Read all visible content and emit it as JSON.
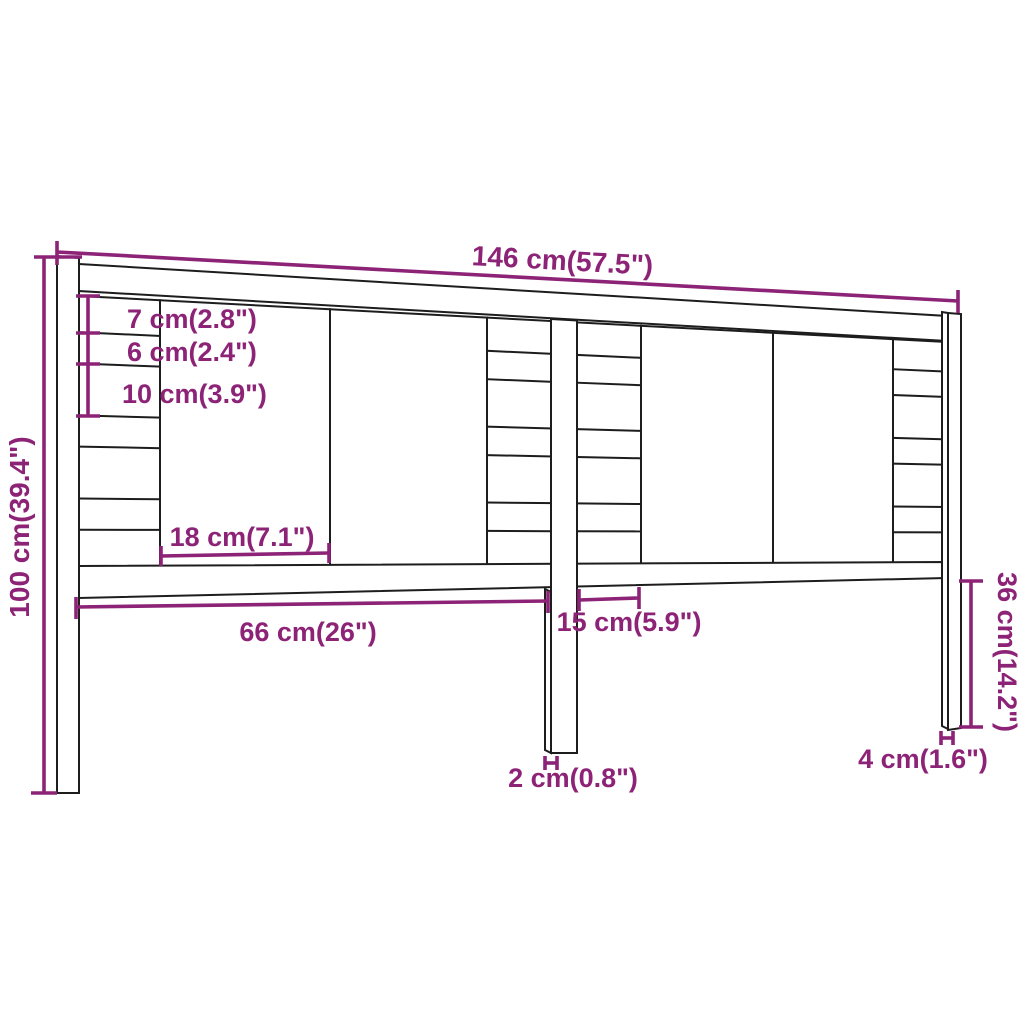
{
  "diagram": {
    "type": "furniture-dimension-drawing",
    "subject": "headboard line drawing with dimension callouts",
    "colors": {
      "dimension_accent": "#8d2377",
      "outline": "#1d1d1d",
      "background": "#ffffff"
    },
    "dims": {
      "total_width": {
        "label": "146 cm(57.5\")"
      },
      "total_height": {
        "label": "100 cm(39.4\")"
      },
      "top_slat_height": {
        "label": "7 cm(2.8\")"
      },
      "slat_gap": {
        "label": "6 cm(2.4\")"
      },
      "wide_slat_height": {
        "label": "10 cm(3.9\")"
      },
      "panel_width": {
        "label": "18 cm(7.1\")"
      },
      "left_span": {
        "label": "66 cm(26\")"
      },
      "center_span": {
        "label": "15 cm(5.9\")"
      },
      "leg_thickness": {
        "label": "2 cm(0.8\")"
      },
      "leg_height": {
        "label": "36 cm(14.2\")"
      },
      "leg_width": {
        "label": "4 cm(1.6\")"
      }
    }
  }
}
